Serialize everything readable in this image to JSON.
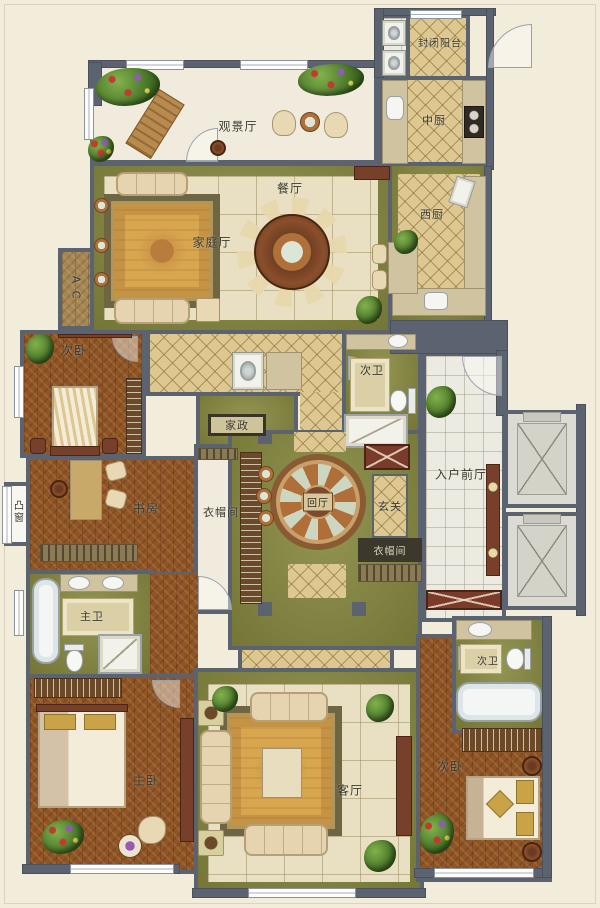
{
  "title": "residential-floor-plan",
  "colors": {
    "background": "#f2ecdb",
    "wall": "#5b6270",
    "olive_floor": "#87893f",
    "wood_floor": "#8f5526",
    "beige_tile": "#e9e0c3",
    "diamond_tile": "#ddc892",
    "white_tile": "#ecebe1",
    "rug_gold": "#d7a64e",
    "accent_wood": "#7a3b2b",
    "plant_green": "#4e7a2b",
    "elevator_gray": "#dbdad3"
  },
  "rooms": {
    "viewing_hall": {
      "label": "观景厅"
    },
    "enclosed_balcony": {
      "label": "封闭阳台"
    },
    "chinese_kitchen": {
      "label": "中厨"
    },
    "dining_room": {
      "label": "餐厅"
    },
    "family_hall": {
      "label": "家庭厅"
    },
    "west_kitchen": {
      "label": "西厨"
    },
    "ac_platform": {
      "label": "A C"
    },
    "bedroom_left": {
      "label": "次卧"
    },
    "bath_top": {
      "label": "次卫"
    },
    "housekeeping": {
      "label": "家政"
    },
    "study": {
      "label": "书房"
    },
    "bay_window": {
      "label": "凸窗"
    },
    "walkin_closet": {
      "label": "衣帽间"
    },
    "central_hall": {
      "label": "回厅"
    },
    "entry_hall": {
      "label": "玄关"
    },
    "closet_small": {
      "label": "衣帽间"
    },
    "foyer": {
      "label": "入户前厅"
    },
    "master_bath": {
      "label": "主卫"
    },
    "master_bedroom": {
      "label": "主卧"
    },
    "living_room": {
      "label": "客厅"
    },
    "bath_right": {
      "label": "次卫"
    },
    "bedroom_right": {
      "label": "次卧"
    }
  }
}
